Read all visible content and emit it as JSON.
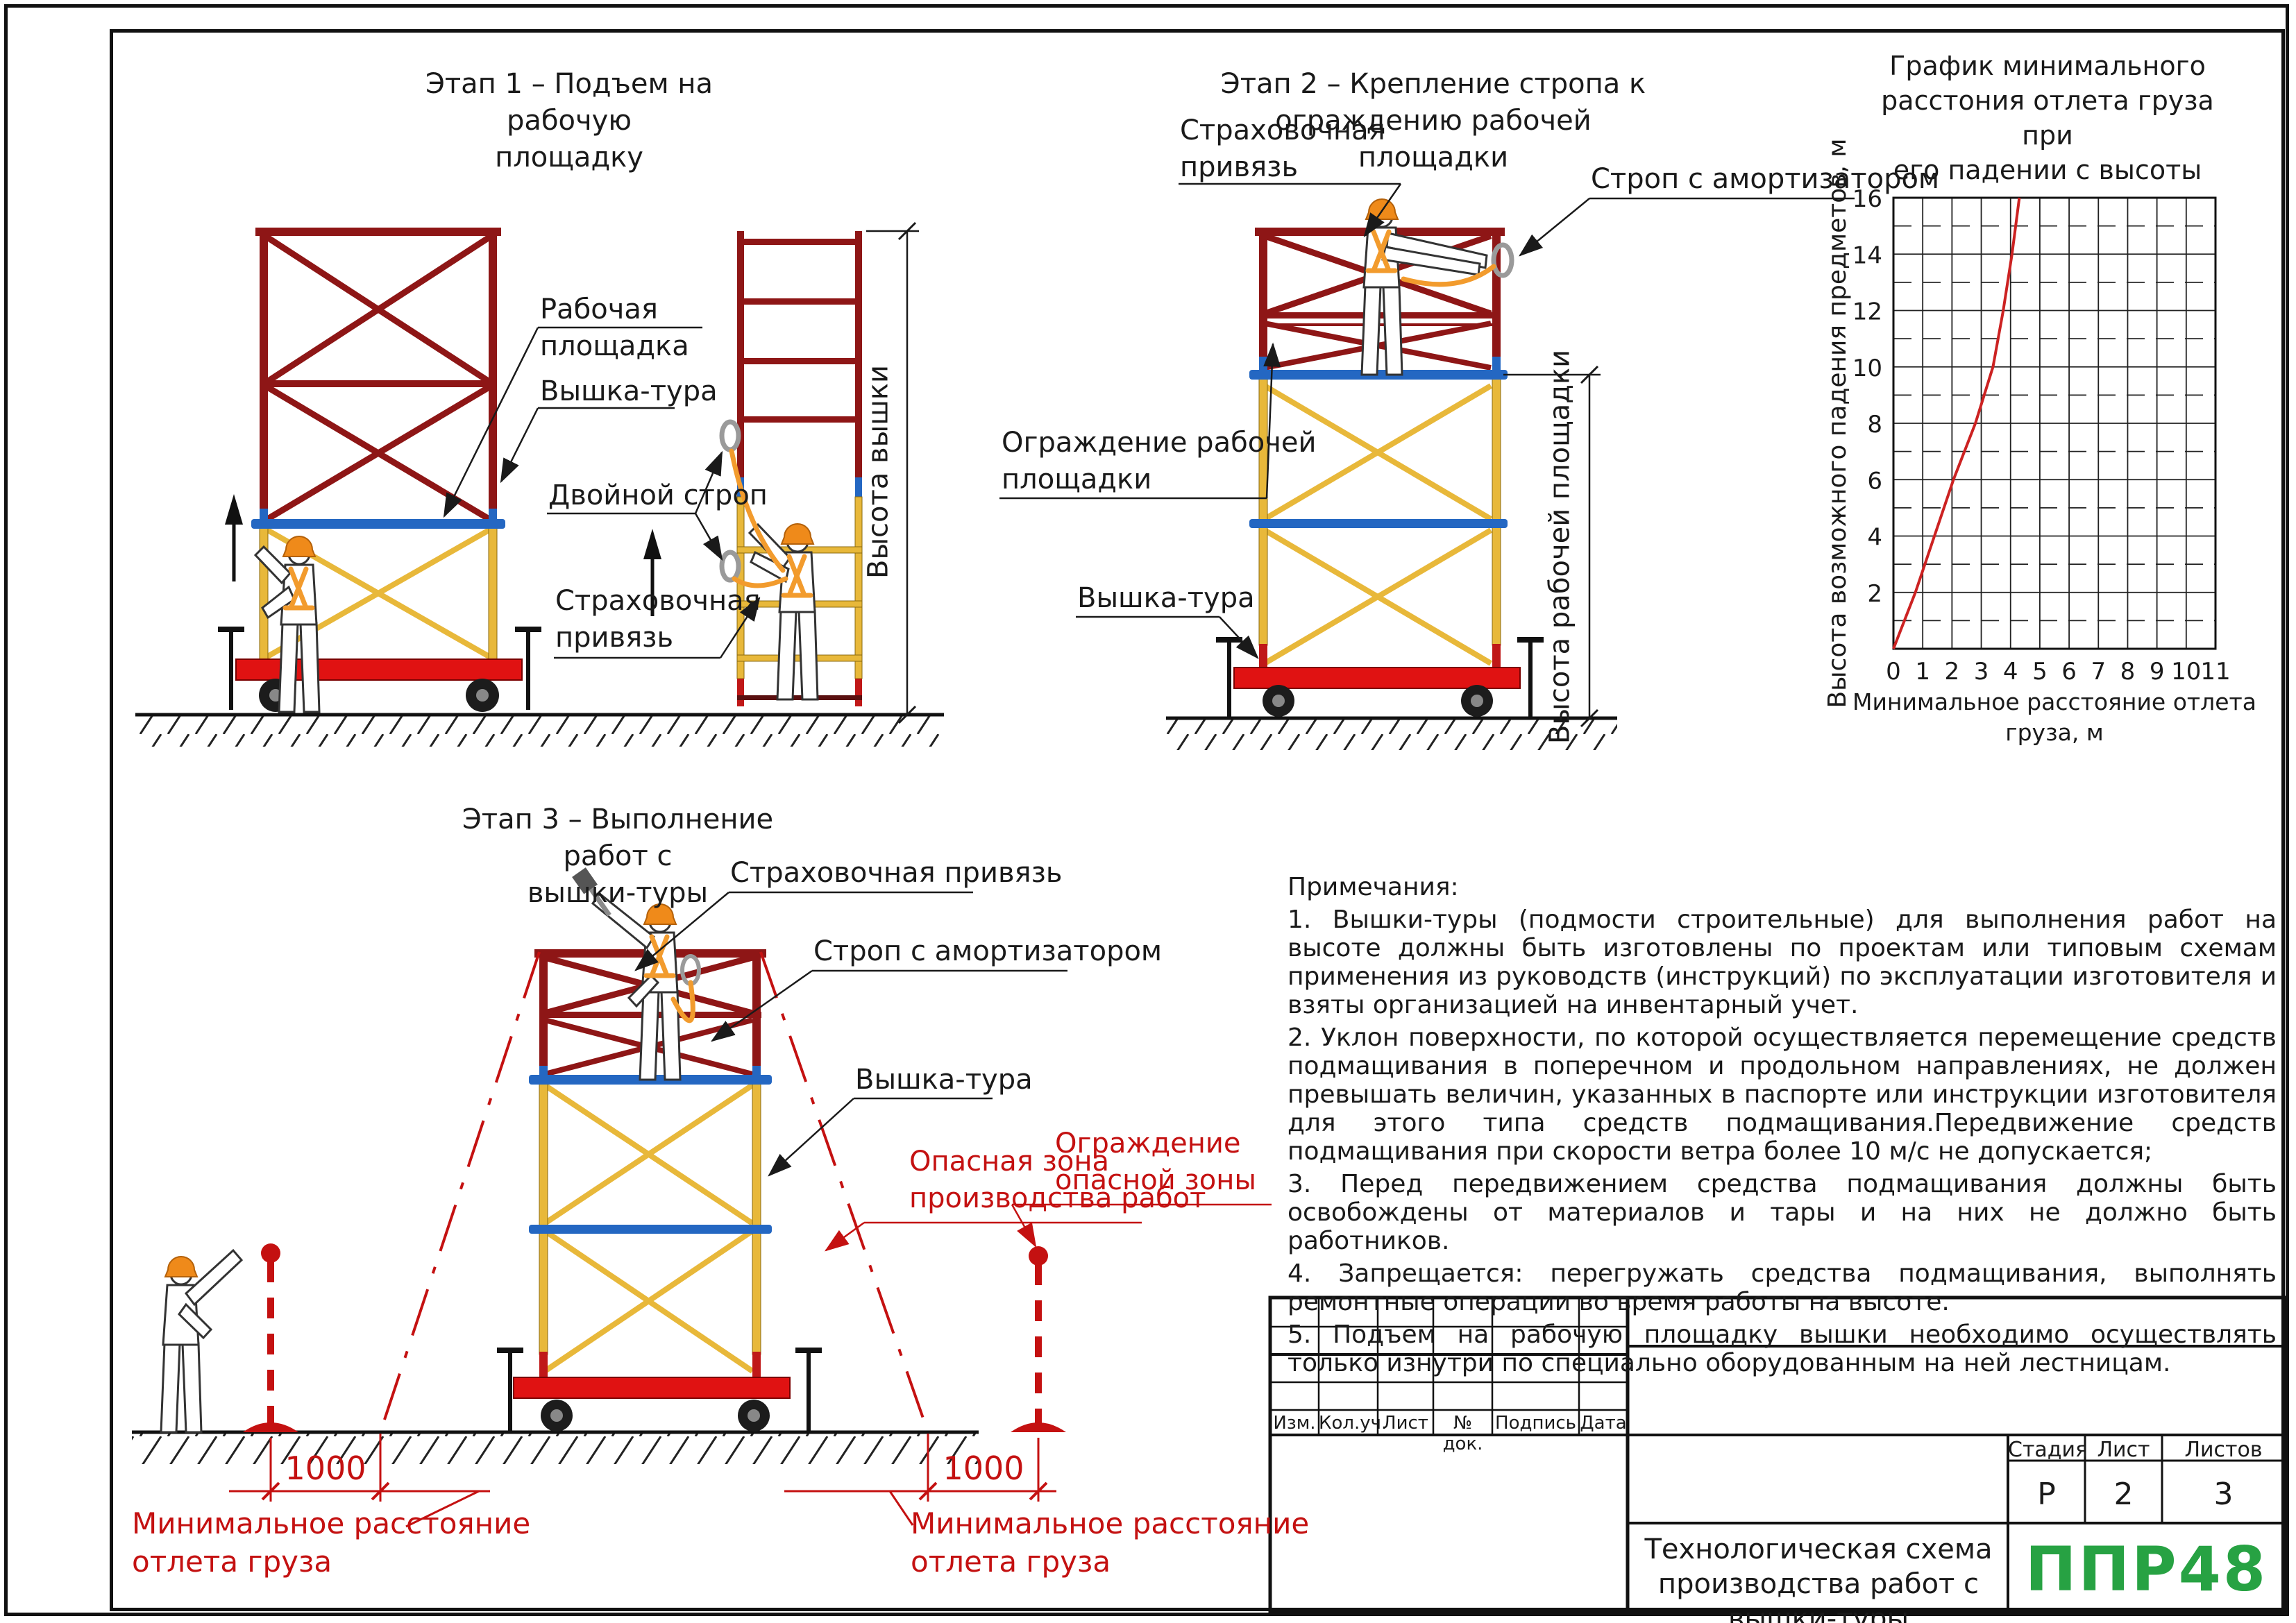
{
  "stage1": {
    "title": "Этап 1 – Подъем на рабочую\nплощадку",
    "labels": {
      "work_platform": "Рабочая\nплощадка",
      "tower": "Вышка-тура",
      "double_sling": "Двойной строп",
      "safety_harness": "Страховочная\nпривязь",
      "tower_height_dim": "Высота вышки"
    }
  },
  "stage2": {
    "title": "Этап 2 – Крепление стропа к\nограждению рабочей площадки",
    "labels": {
      "safety_harness": "Страховочная\nпривязь",
      "sling_with_absorber": "Строп с амортизатором",
      "platform_guard": "Ограждение рабочей\nплощадки",
      "tower": "Вышка-тура",
      "platform_height_dim": "Высота рабочей площадки"
    }
  },
  "stage3": {
    "title": "Этап 3 – Выполнение работ с\nвышки-туры",
    "labels": {
      "safety_harness": "Страховочная привязь",
      "sling_with_absorber": "Строп с амортизатором",
      "tower": "Вышка-тура",
      "danger_zone": "Опасная зона\nпроизводства работ",
      "danger_fence": "Ограждение\nопасной зоны",
      "min_distance_left": "Минимальное расстояние\nотлета груза",
      "min_distance_right": "Минимальное расстояние\nотлета груза"
    },
    "dim_left_value": "1000",
    "dim_right_value": "1000"
  },
  "chart_data": {
    "type": "line",
    "title": "График минимального\nрасстония отлета груза при\nего падении с высоты",
    "xlabel": "Минимальное расстояние отлета груза, м",
    "ylabel": "Высота возможного падения предметов, м",
    "xlim": [
      0,
      11
    ],
    "ylim": [
      0,
      16
    ],
    "x_ticks": [
      0,
      1,
      2,
      3,
      4,
      5,
      6,
      7,
      8,
      9,
      10,
      11
    ],
    "y_ticks": [
      2,
      4,
      6,
      8,
      10,
      12,
      14,
      16
    ],
    "grid": {
      "vertical": "every 1, solid",
      "horizontal_even": "solid",
      "horizontal_odd": "dashed"
    },
    "legend": "none",
    "series": [
      {
        "name": "минимальное расстояние отлета груза",
        "color": "#cc2222",
        "points": [
          [
            0,
            0
          ],
          [
            0.75,
            2
          ],
          [
            1.4,
            4
          ],
          [
            2.05,
            6
          ],
          [
            2.8,
            8
          ],
          [
            3.4,
            10
          ],
          [
            3.75,
            12
          ],
          [
            4.05,
            14
          ],
          [
            4.3,
            16
          ]
        ]
      }
    ]
  },
  "notes": {
    "heading": "Примечания:",
    "items": [
      "1.  Вышки-туры (подмости строительные) для выполнения работ на высоте должны быть изготовлены по проектам или типовым схемам применения из руководств (инструкций) по эксплуатации изготовителя и взяты организацией на инвентарный учет.",
      "2.  Уклон поверхности, по которой осуществляется перемещение средств подмащивания в поперечном и продольном направлениях, не должен превышать величин, указанных в паспорте или инструкции изготовителя для этого типа средств подмащивания.Передвижение средств подмащивания при скорости ветра более 10 м/с не допускается;",
      "3.  Перед передвижением средства подмащивания должны быть освобождены от материалов и тары и на них не должно быть работников.",
      "4.  Запрещается: перегружать средства подмащивания, выполнять ремонтные операции во время работы на высоте.",
      "5.  Подъем на рабочую площадку вышки необходимо осуществлять только изнутри по специально оборудованным на ней лестницам."
    ]
  },
  "title_block": {
    "revision_headers": [
      "Изм.",
      "Кол.уч.",
      "Лист",
      "№ док.",
      "Подпись",
      "Дата"
    ],
    "stage_header": "Стадия",
    "sheet_header": "Лист",
    "sheets_header": "Листов",
    "stage_value": "Р",
    "sheet_value": "2",
    "sheets_value": "3",
    "doc_title": "Технологическая схема\nпроизводства работ с\nвышки-туры",
    "logo": "ППР48",
    "logo_color": "#27a243"
  },
  "colors": {
    "frame_red_dark": "#8e1616",
    "frame_red_bright": "#e01212",
    "frame_blue": "#2467c2",
    "frame_yellow": "#e8b83a",
    "annotation_red": "#c41111",
    "harness_orange": "#f29b2d"
  }
}
